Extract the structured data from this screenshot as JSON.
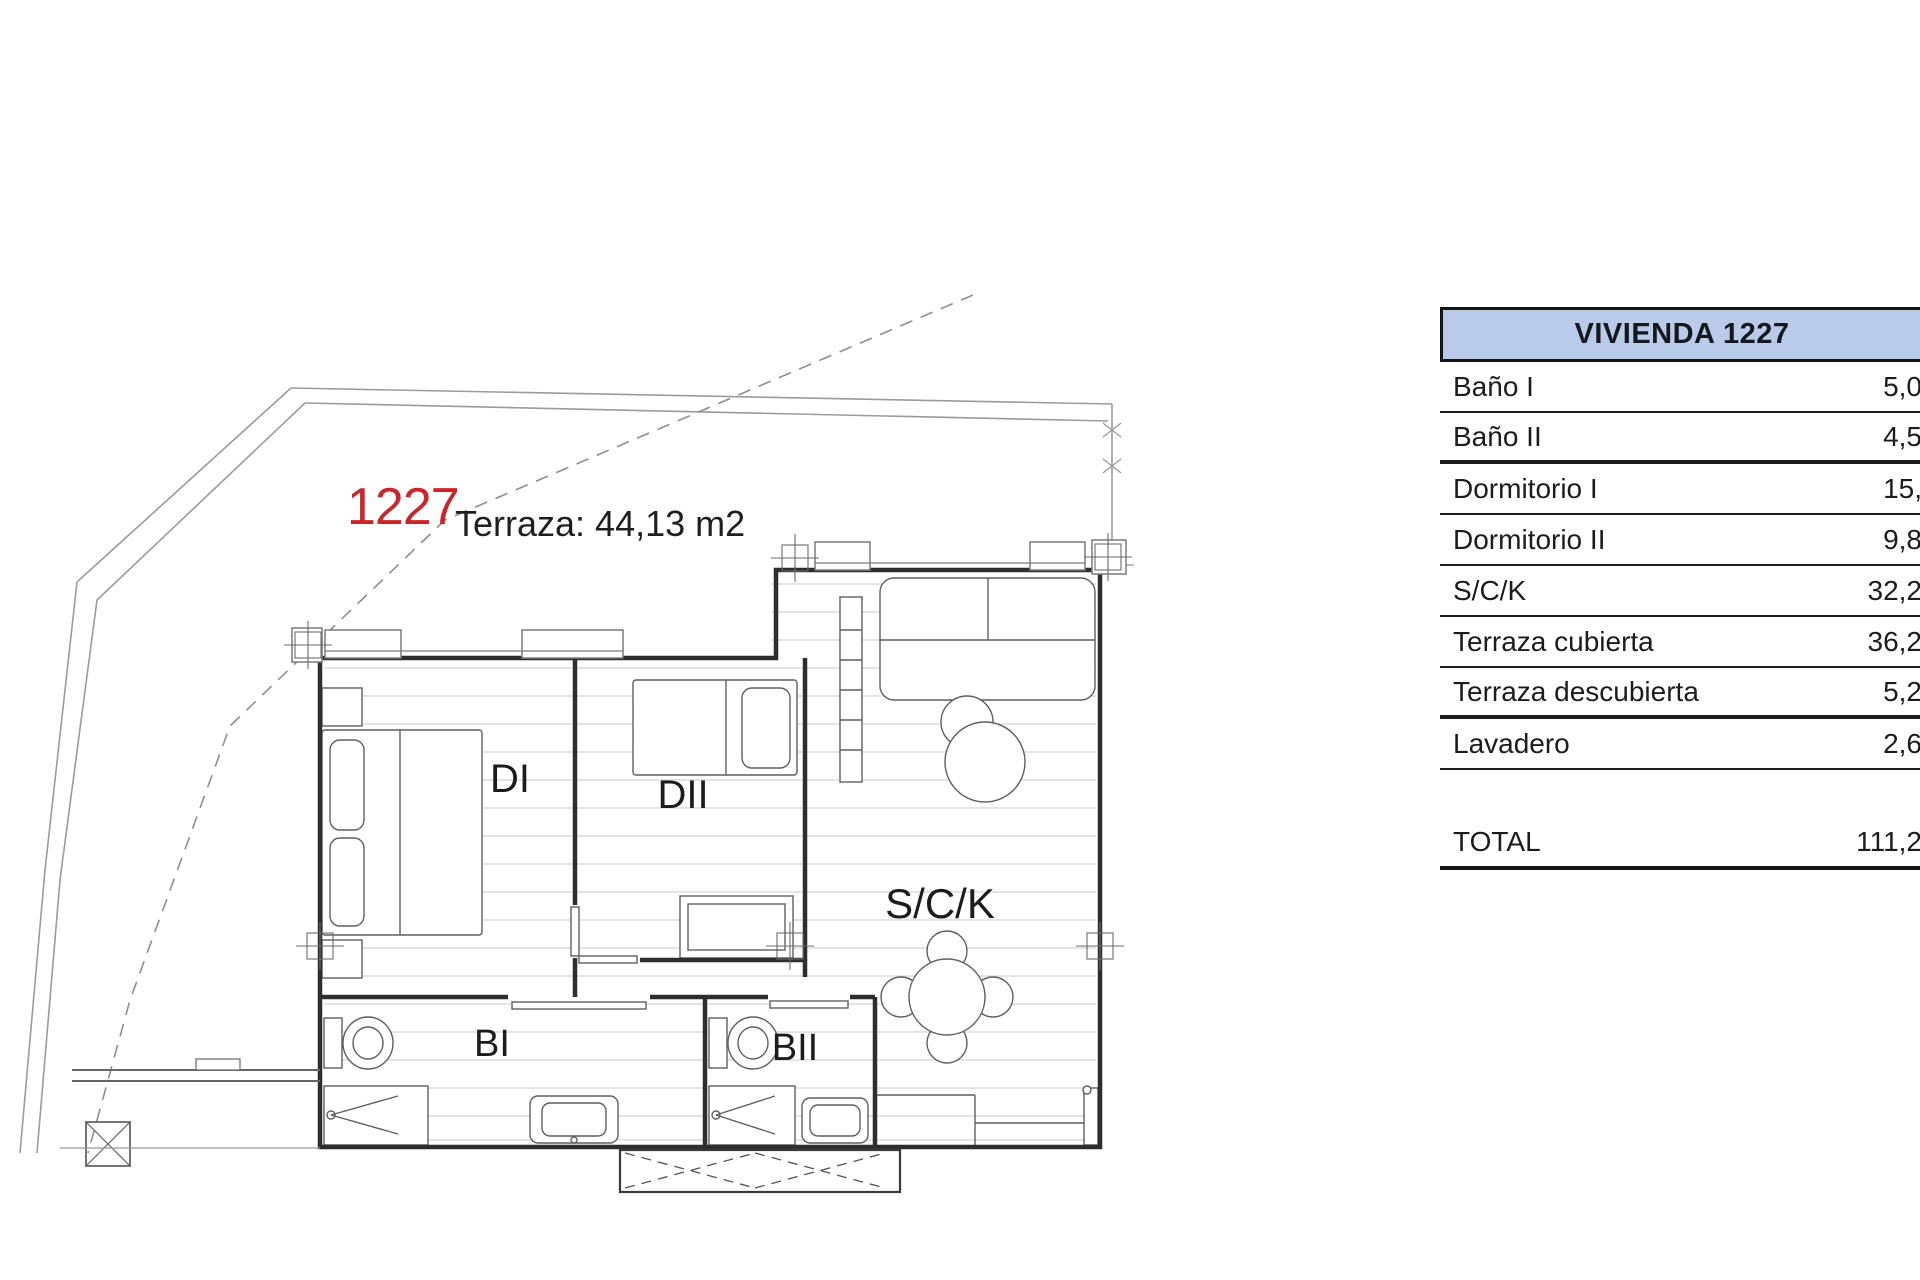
{
  "plan": {
    "unit_number": "1227",
    "terrace_label": "Terraza: 44,13 m2",
    "accent_red": "#c9252b",
    "room_labels": {
      "di": "DI",
      "dii": "DII",
      "sck": "S/C/K",
      "bi": "BI",
      "bii": "BII"
    }
  },
  "area_table": {
    "header": "VIVIENDA 1227",
    "header_fill": "#b9cbe8",
    "rows": [
      {
        "label": "Baño I",
        "value": "5,0"
      },
      {
        "label": "Baño II",
        "value": "4,5"
      },
      {
        "label": "Dormitorio I",
        "value": "15,"
      },
      {
        "label": "Dormitorio II",
        "value": "9,8"
      },
      {
        "label": "S/C/K",
        "value": "32,2"
      },
      {
        "label": "Terraza cubierta",
        "value": "36,2"
      },
      {
        "label": "Terraza descubierta",
        "value": "5,2"
      },
      {
        "label": "Lavadero",
        "value": "2,6"
      }
    ],
    "total": {
      "label": "TOTAL",
      "value": "111,2"
    }
  }
}
